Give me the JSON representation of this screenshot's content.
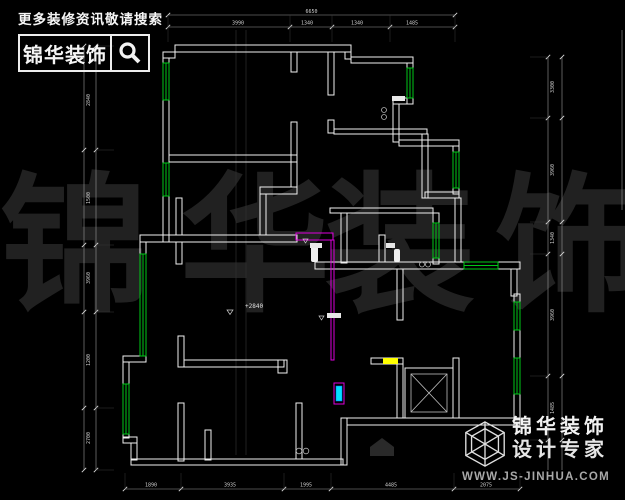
{
  "page": {
    "background": "#000000",
    "width": 625,
    "height": 500
  },
  "search_banner": {
    "tagline": "更多装修资讯敬请搜索",
    "brand": "锦华装饰",
    "icon": "magnifier-icon"
  },
  "watermark": {
    "characters": [
      "锦",
      "华",
      "装",
      "饰"
    ],
    "color": "#212121"
  },
  "brand_footer": {
    "icon": "cube-logo-icon",
    "name": "锦华装饰",
    "subtitle": "设计专家",
    "website": "WWW.JS-JINHUA.COM"
  },
  "floorplan": {
    "colors": {
      "wall": "#f0f0f0",
      "window": "#00c818",
      "revision": "#dd00dd",
      "door_highlight": "#00e1ff",
      "marker": "#ffff00",
      "elevator_inner": "#bfbfbf",
      "dimension_line": "#9a9a9a",
      "dimension_text": "#cfcfcf",
      "extension_line": "#383838"
    },
    "annotations": {
      "level_label": "+2840"
    },
    "dimensions": {
      "top": {
        "y_overall": 15,
        "y_seg": 27,
        "x_start": 168,
        "x_end": 455,
        "overall": "6650",
        "ticks": [
          168,
          290,
          332,
          390,
          455
        ],
        "labels": [
          {
            "t": "3990",
            "x": 238
          },
          {
            "t": "1340",
            "x": 307
          },
          {
            "t": "1340",
            "x": 357
          },
          {
            "t": "1485",
            "x": 412
          }
        ]
      },
      "bottom": {
        "y": 489,
        "x_start": 125,
        "x_end": 520,
        "ticks": [
          125,
          181,
          284,
          331,
          454,
          520
        ],
        "labels": [
          {
            "t": "1890",
            "x": 151
          },
          {
            "t": "3935",
            "x": 230
          },
          {
            "t": "1995",
            "x": 306
          },
          {
            "t": "4485",
            "x": 391
          },
          {
            "t": "2075",
            "x": 486
          }
        ]
      },
      "left": {
        "x_line1": 84,
        "x_line2": 96,
        "y_start": 46,
        "y_end": 470,
        "ticks": [
          46,
          150,
          245,
          312,
          408,
          470
        ],
        "labels": [
          {
            "t": "2840",
            "y": 100
          },
          {
            "t": "1500",
            "y": 198
          },
          {
            "t": "3960",
            "y": 278
          },
          {
            "t": "1200",
            "y": 360
          },
          {
            "t": "2700",
            "y": 438
          }
        ]
      },
      "right": {
        "x_line1": 548,
        "x_line2": 562,
        "y_start": 57,
        "y_end": 470,
        "x_extra": 622,
        "extra_y": [
          30,
          210
        ],
        "ticks": [
          57,
          118,
          222,
          254,
          376,
          440
        ],
        "labels": [
          {
            "t": "3300",
            "y": 87
          },
          {
            "t": "3960",
            "y": 170
          },
          {
            "t": "1340",
            "y": 238
          },
          {
            "t": "3960",
            "y": 315
          },
          {
            "t": "1485",
            "y": 408
          }
        ]
      }
    }
  }
}
